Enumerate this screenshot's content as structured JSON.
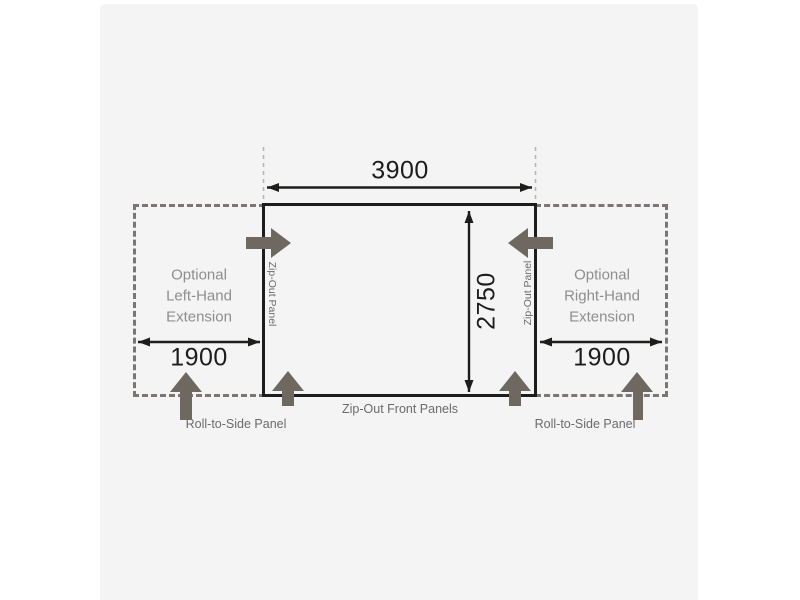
{
  "diagram": {
    "type": "awning-floorplan-dimension-diagram",
    "dimensions": {
      "main_width": "3900",
      "main_depth": "2750",
      "left_extension_width": "1900",
      "right_extension_width": "1900"
    },
    "labels": {
      "left_extension": "Optional\nLeft-Hand\nExtension",
      "right_extension": "Optional\nRight-Hand\nExtension",
      "zip_out_panel_left": "Zip-Out Panel",
      "zip_out_panel_right": "Zip-Out Panel",
      "zip_out_front_panels": "Zip-Out Front Panels",
      "roll_to_side_left": "Roll-to-Side Panel",
      "roll_to_side_right": "Roll-to-Side Panel"
    },
    "icons": {
      "left_zip_arrow": "arrow-right-icon",
      "right_zip_arrow": "arrow-left-icon",
      "front_panel_arrows": "arrow-up-icon",
      "roll_to_side_arrows": "arrow-up-icon"
    },
    "colors": {
      "canvas_bg": "#ffffff",
      "card_bg": "#f4f4f4",
      "line_dark": "#1d1d1b",
      "extension_dash_gray": "#7b7674",
      "guide_dash_gray": "#b6b4b2",
      "block_arrow_gray": "#6e6861",
      "extension_label_gray": "#8e8e8e",
      "caption_gray": "#6b6b6b"
    }
  }
}
